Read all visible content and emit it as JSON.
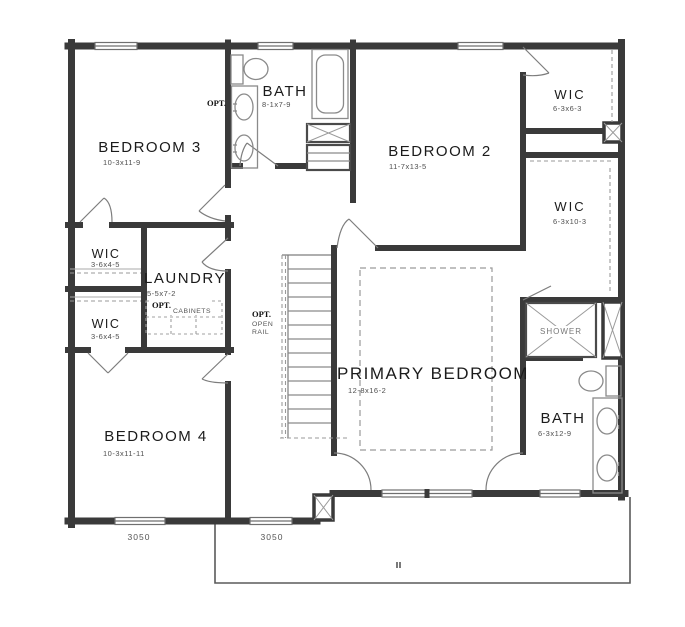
{
  "title": "Second floor plan",
  "colors": {
    "background": "#ffffff",
    "wall": "#3a3a3a",
    "fixture_line": "#8a8a8a",
    "dashed_line": "#9a9a9a",
    "label_text": "#1b1b1b",
    "dim_text": "#4f4f4f"
  },
  "rooms": {
    "bedroom3": {
      "label": "BEDROOM 3",
      "dims": "10-3x11-9"
    },
    "bath_upper": {
      "label": "BATH",
      "dims": "8-1x7-9",
      "opt": "OPT."
    },
    "bedroom2": {
      "label": "BEDROOM 2",
      "dims": "11-7x13-5"
    },
    "wic_top_right": {
      "label": "WIC",
      "dims": "6-3x6-3"
    },
    "wic_right": {
      "label": "WIC",
      "dims": "6-3x10-3"
    },
    "wic_left_upper": {
      "label": "WIC",
      "dims": "3-6x4-5"
    },
    "wic_left_lower": {
      "label": "WIC",
      "dims": "3-6x4-5"
    },
    "laundry": {
      "label": "LAUNDRY",
      "dims": "5-5x7-2",
      "opt": "OPT.",
      "cabinets": "CABINETS"
    },
    "primary": {
      "label": "PRIMARY BEDROOM",
      "dims": "12-8x16-2"
    },
    "bath_primary": {
      "label": "BATH",
      "dims": "6-3x12-9"
    },
    "bedroom4": {
      "label": "BEDROOM 4",
      "dims": "10-3x11-11"
    },
    "shower": {
      "label": "SHOWER"
    }
  },
  "stairs": {
    "opt": "OPT.",
    "open": "OPEN",
    "rail": "RAIL"
  },
  "windows": {
    "left": "3050",
    "right": "3050"
  }
}
